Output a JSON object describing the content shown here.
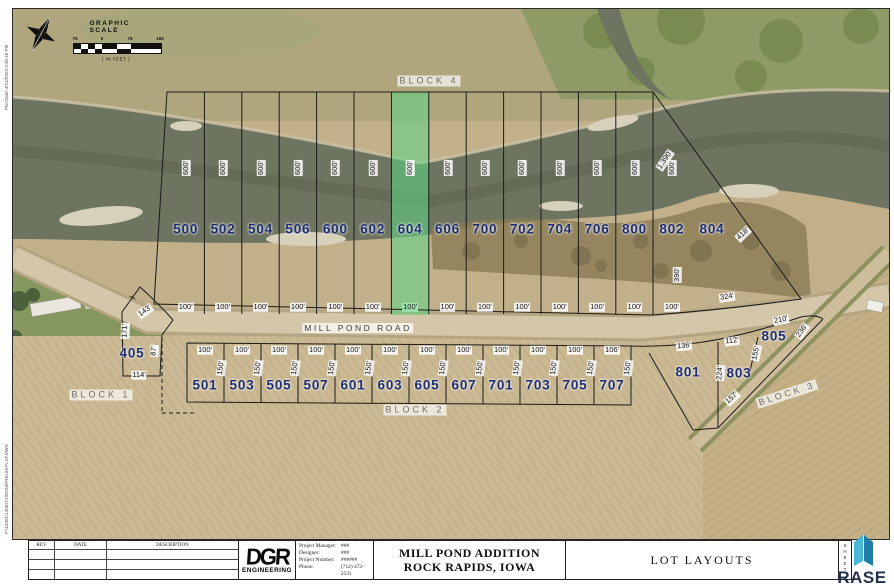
{
  "frame": {
    "plot_date": "Plot Date: 4/14/2023 3:36:48 PM",
    "file_path": "P:\\16301\\1306271\\DGN\\PRELIM PLAT.DWG"
  },
  "scale_bar": {
    "title": "GRAPHIC SCALE",
    "ticks": [
      "75",
      "0",
      "75",
      "150"
    ],
    "units": "( IN FEET )"
  },
  "map": {
    "road_label": "MILL POND ROAD",
    "blocks": [
      {
        "label": "BLOCK 1"
      },
      {
        "label": "BLOCK 2"
      },
      {
        "label": "BLOCK 3"
      },
      {
        "label": "BLOCK 4"
      }
    ],
    "top_row": {
      "lots": [
        "500",
        "502",
        "504",
        "506",
        "600",
        "602",
        "604",
        "606",
        "700",
        "702",
        "704",
        "706",
        "800",
        "802"
      ],
      "frontage": "100'",
      "depth": "600'",
      "highlighted": "604"
    },
    "bottom_row": {
      "lots": [
        "501",
        "503",
        "505",
        "507",
        "601",
        "603",
        "605",
        "607",
        "701",
        "703",
        "705",
        "707"
      ],
      "frontage": "100'",
      "last_frontage": "106'",
      "depth": "150'"
    },
    "lot_804": {
      "id": "804",
      "dim_ne": "1,390'",
      "dim_se": "418'",
      "dim_w": "390'",
      "dim_road": "324'"
    },
    "lot_405": {
      "id": "405",
      "dim_arc": "143'",
      "dim_w": "171'",
      "dim_e": "87'",
      "dim_s": "114'"
    },
    "lot_801": {
      "id": "801",
      "dim_road": "136'"
    },
    "lot_803": {
      "id": "803",
      "dim_road": "112'",
      "dim_w": "224'",
      "dim_se": "157'"
    },
    "lot_805": {
      "id": "805",
      "dim_road": "210'",
      "dim_ne": "236'",
      "dim_w": "155'"
    },
    "highlight_color": "#5fd685"
  },
  "title_block": {
    "rev_headers": [
      "REV",
      "DATE",
      "DESCRIPTION"
    ],
    "firm_name": "DGR",
    "firm_sub": "ENGINEERING",
    "project_rows": [
      {
        "label": "Project Manager:",
        "value": "###"
      },
      {
        "label": "Designer:",
        "value": "###"
      },
      {
        "label": "Project Number:",
        "value": "######"
      },
      {
        "label": "Phone:",
        "value": "(712) 472-2531"
      }
    ],
    "project_title_line1": "MILL POND ADDITION",
    "project_title_line2": "ROCK RAPIDS, IOWA",
    "sheet_title": "LOT LAYOUTS",
    "sheet_label": "SHEET"
  },
  "watermark": {
    "text": "RASE"
  }
}
